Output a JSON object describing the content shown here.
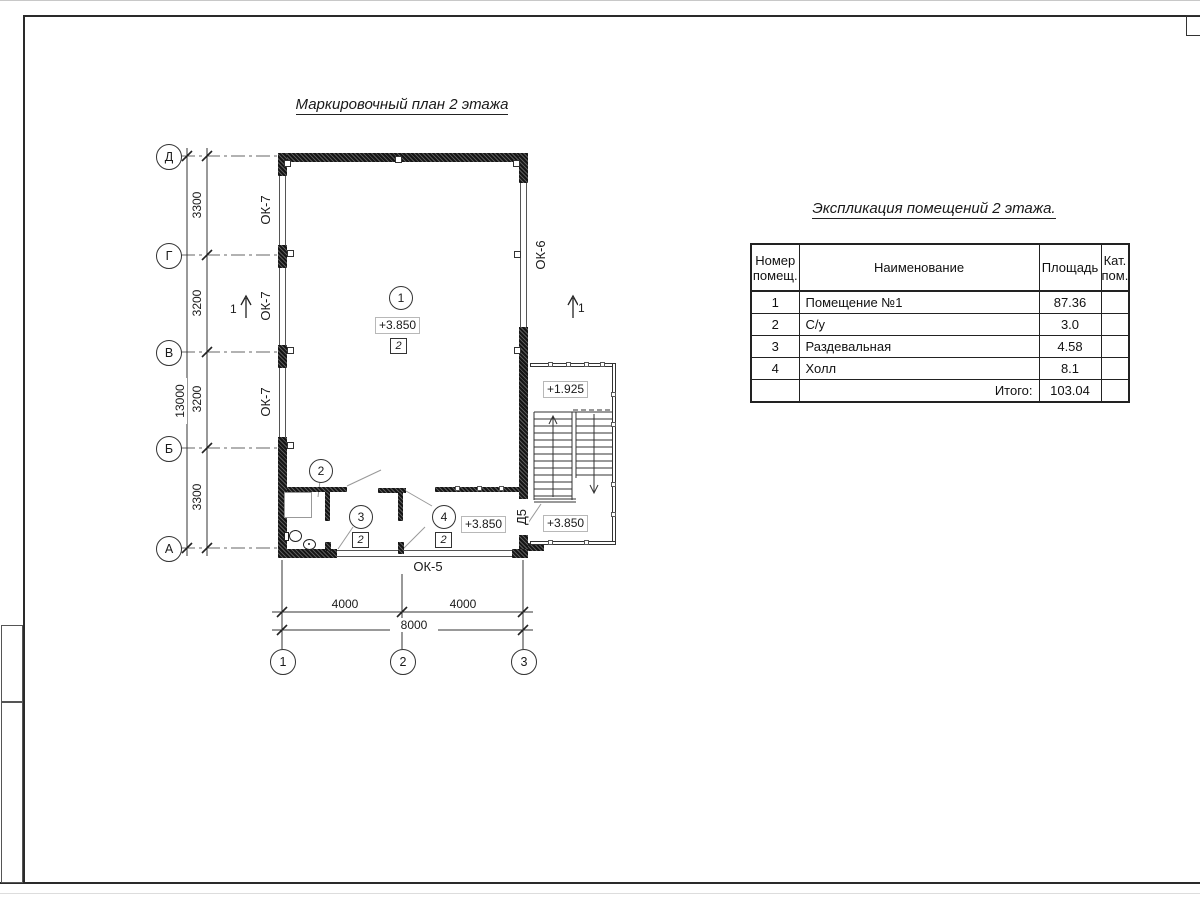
{
  "page": {
    "plan_title": "Маркировочный план 2 этажа",
    "table_title": "Экспликация помещений 2 этажа."
  },
  "axes": {
    "v": [
      "Д",
      "Г",
      "В",
      "Б",
      "А"
    ],
    "h": [
      "1",
      "2",
      "3"
    ]
  },
  "dimensions": {
    "left_segments": [
      "3300",
      "3200",
      "3200",
      "3300"
    ],
    "left_total": "13000",
    "bottom_segments": [
      "4000",
      "4000"
    ],
    "bottom_total": "8000"
  },
  "labels": {
    "window_ok7": "ОК-7",
    "window_ok6": "ОК-6",
    "window_ok5": "ОК-5",
    "door_d5": "Д5"
  },
  "marks": {
    "room1_num": "1",
    "room2_num": "2",
    "room3_num": "3",
    "room4_num": "4",
    "finish_room1": "2",
    "finish_room3": "2",
    "finish_room4": "2",
    "elev_room1": "+3.850",
    "elev_hall": "+3.850",
    "elev_stair_lower": "+3.850",
    "elev_stair_landing": "+1.925",
    "section_left": "1",
    "section_right": "1"
  },
  "table": {
    "headers": {
      "num": "Номер помещ.",
      "name": "Наименование",
      "area": "Площадь",
      "cat": "Кат. пом."
    },
    "rows": [
      {
        "num": "1",
        "name": "Помещение №1",
        "area": "87.36",
        "cat": ""
      },
      {
        "num": "2",
        "name": "С/у",
        "area": "3.0",
        "cat": ""
      },
      {
        "num": "3",
        "name": "Раздевальная",
        "area": "4.58",
        "cat": ""
      },
      {
        "num": "4",
        "name": "Холл",
        "area": "8.1",
        "cat": ""
      }
    ],
    "total_label": "Итого:",
    "total_value": "103.04"
  }
}
